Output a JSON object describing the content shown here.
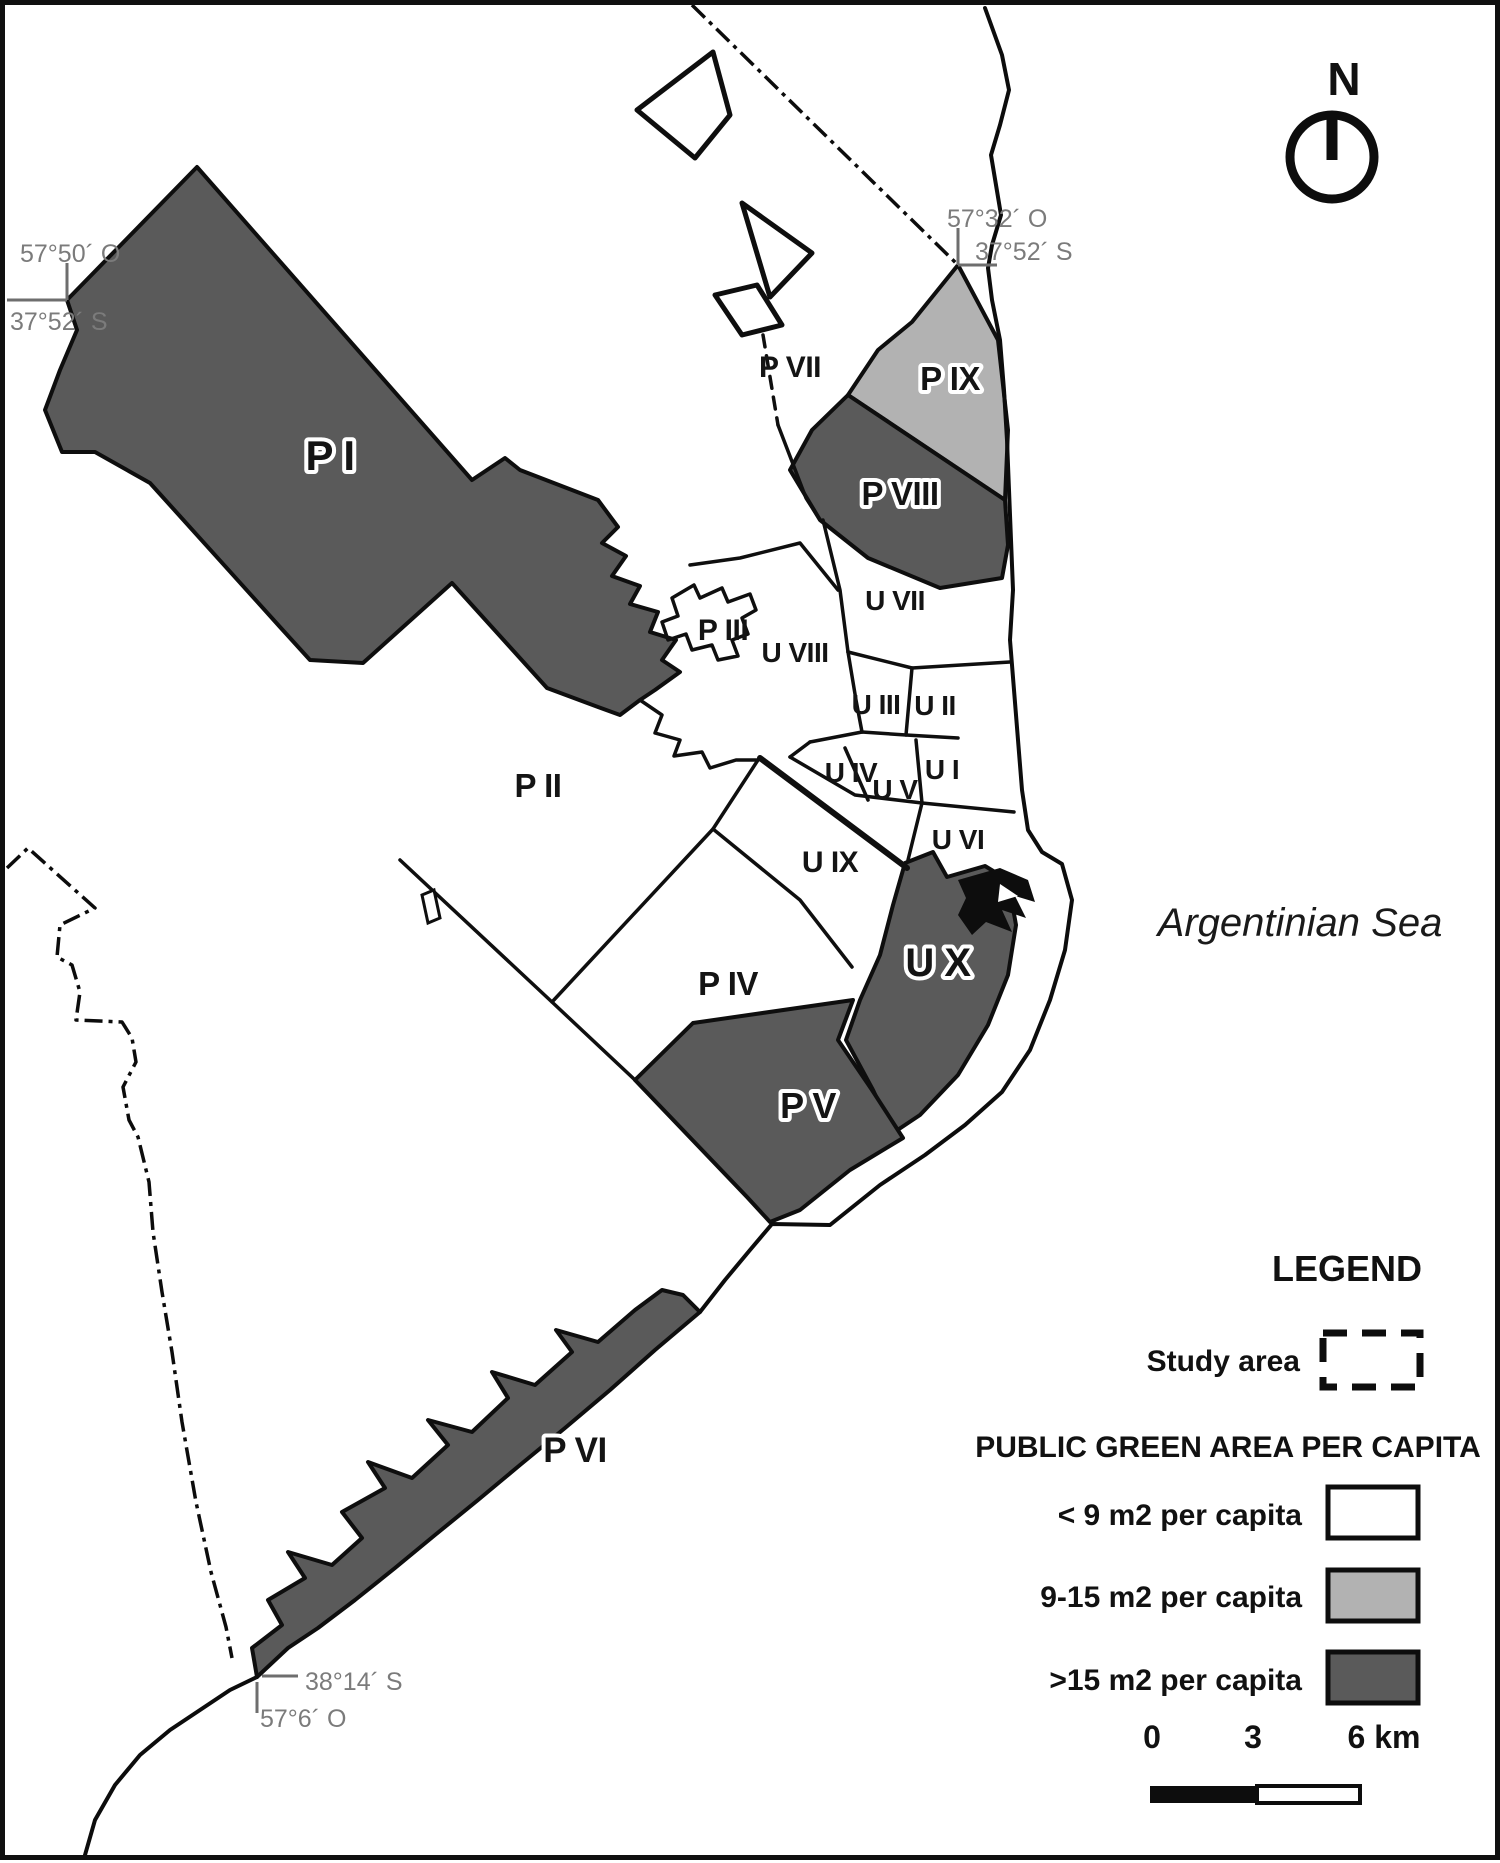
{
  "map": {
    "north_label": "N",
    "sea_label": "Argentinian Sea",
    "coordinates": {
      "top_left_lon": "57°50´ O",
      "top_left_lat": "37°52´ S",
      "top_right_lon": "57°32´ O",
      "top_right_lat": "37°52´ S",
      "bottom_left_lat": "38°14´ S",
      "bottom_left_lon": "57°6´ O"
    },
    "regions": [
      {
        "label": "P I",
        "green_area_class": ">15 m2 per capita"
      },
      {
        "label": "P II",
        "green_area_class": "< 9 m2 per capita"
      },
      {
        "label": "P III",
        "green_area_class": "< 9 m2 per capita"
      },
      {
        "label": "P IV",
        "green_area_class": "< 9 m2 per capita"
      },
      {
        "label": "P V",
        "green_area_class": ">15 m2 per capita"
      },
      {
        "label": "P VI",
        "green_area_class": ">15 m2 per capita"
      },
      {
        "label": "P VII",
        "green_area_class": "< 9 m2 per capita"
      },
      {
        "label": "P VIII",
        "green_area_class": ">15 m2 per capita"
      },
      {
        "label": "P IX",
        "green_area_class": "9-15 m2 per capita"
      },
      {
        "label": "U I",
        "green_area_class": "< 9 m2 per capita"
      },
      {
        "label": "U II",
        "green_area_class": "< 9 m2 per capita"
      },
      {
        "label": "U III",
        "green_area_class": "< 9 m2 per capita"
      },
      {
        "label": "U IV",
        "green_area_class": "< 9 m2 per capita"
      },
      {
        "label": "U V",
        "green_area_class": "< 9 m2 per capita"
      },
      {
        "label": "U VI",
        "green_area_class": "< 9 m2 per capita"
      },
      {
        "label": "U VII",
        "green_area_class": "< 9 m2 per capita"
      },
      {
        "label": "U VIII",
        "green_area_class": "< 9 m2 per capita"
      },
      {
        "label": "U IX",
        "green_area_class": "< 9 m2 per capita"
      },
      {
        "label": "U X",
        "green_area_class": ">15 m2 per capita"
      }
    ]
  },
  "legend": {
    "title": "LEGEND",
    "study_area_label": "Study area",
    "section_title": "PUBLIC GREEN AREA PER CAPITA",
    "classes": [
      {
        "label": "< 9 m2 per capita",
        "color": "#ffffff"
      },
      {
        "label": "9-15 m2 per capita",
        "color": "#b2b2b2"
      },
      {
        "label": ">15 m2 per capita",
        "color": "#5a5a5a"
      }
    ]
  },
  "scale_bar": {
    "tick_0": "0",
    "tick_3": "3",
    "tick_6": "6 km"
  },
  "colors": {
    "class_low": "#ffffff",
    "class_mid": "#b2b2b2",
    "class_high": "#5a5a5a",
    "outline": "#0e0e0e",
    "coordinate_text": "#7b7b7b"
  }
}
